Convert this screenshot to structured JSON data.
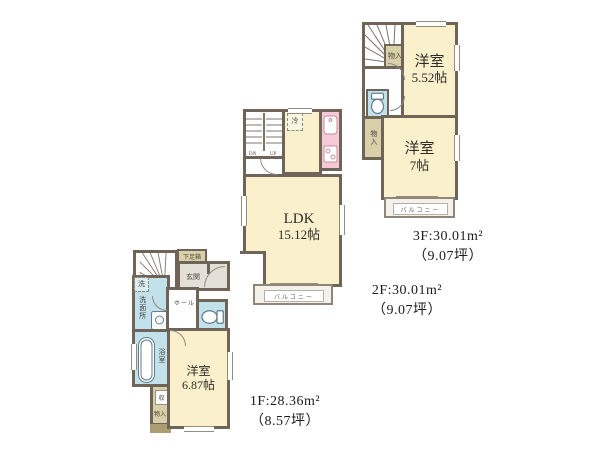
{
  "colors": {
    "wall": "#6e6458",
    "room": "#faf0cb",
    "wet": "#c2e1ea",
    "kitchen": "#f5c9d6",
    "tan": "#d9cfa8",
    "tan_dark": "#ab9c72",
    "gray": "#e3e0d7",
    "balcony": "#f3f1e9",
    "text": "#2e2c29",
    "small_text": "#4a463f"
  },
  "floor1": {
    "caption_line1": "1F:28.36m²",
    "caption_line2": "（8.57坪）",
    "shoe_cabinet": "下足箱",
    "entrance": "玄関",
    "washer": "洗",
    "washroom": "洗面所",
    "hall": "ホール",
    "bath": "浴室",
    "room_name": "洋室",
    "room_size": "6.87帖",
    "storage_top": "収",
    "storage_bottom": "物入"
  },
  "floor2": {
    "caption_line1": "2F:30.01m²",
    "caption_line2": "（9.07坪）",
    "stairs_down": "DN",
    "stairs_up": "UP",
    "fridge": "冷",
    "ldk_name": "LDK",
    "ldk_size": "15.12帖",
    "balcony": "バルコニー"
  },
  "floor3": {
    "caption_line1": "3F:30.01m²",
    "caption_line2": "（9.07坪）",
    "storage_top": "物入",
    "room1_name": "洋室",
    "room1_size": "5.52帖",
    "storage_left": "物入",
    "room2_name": "洋室",
    "room2_size": "7帖",
    "balcony": "バルコニー"
  }
}
